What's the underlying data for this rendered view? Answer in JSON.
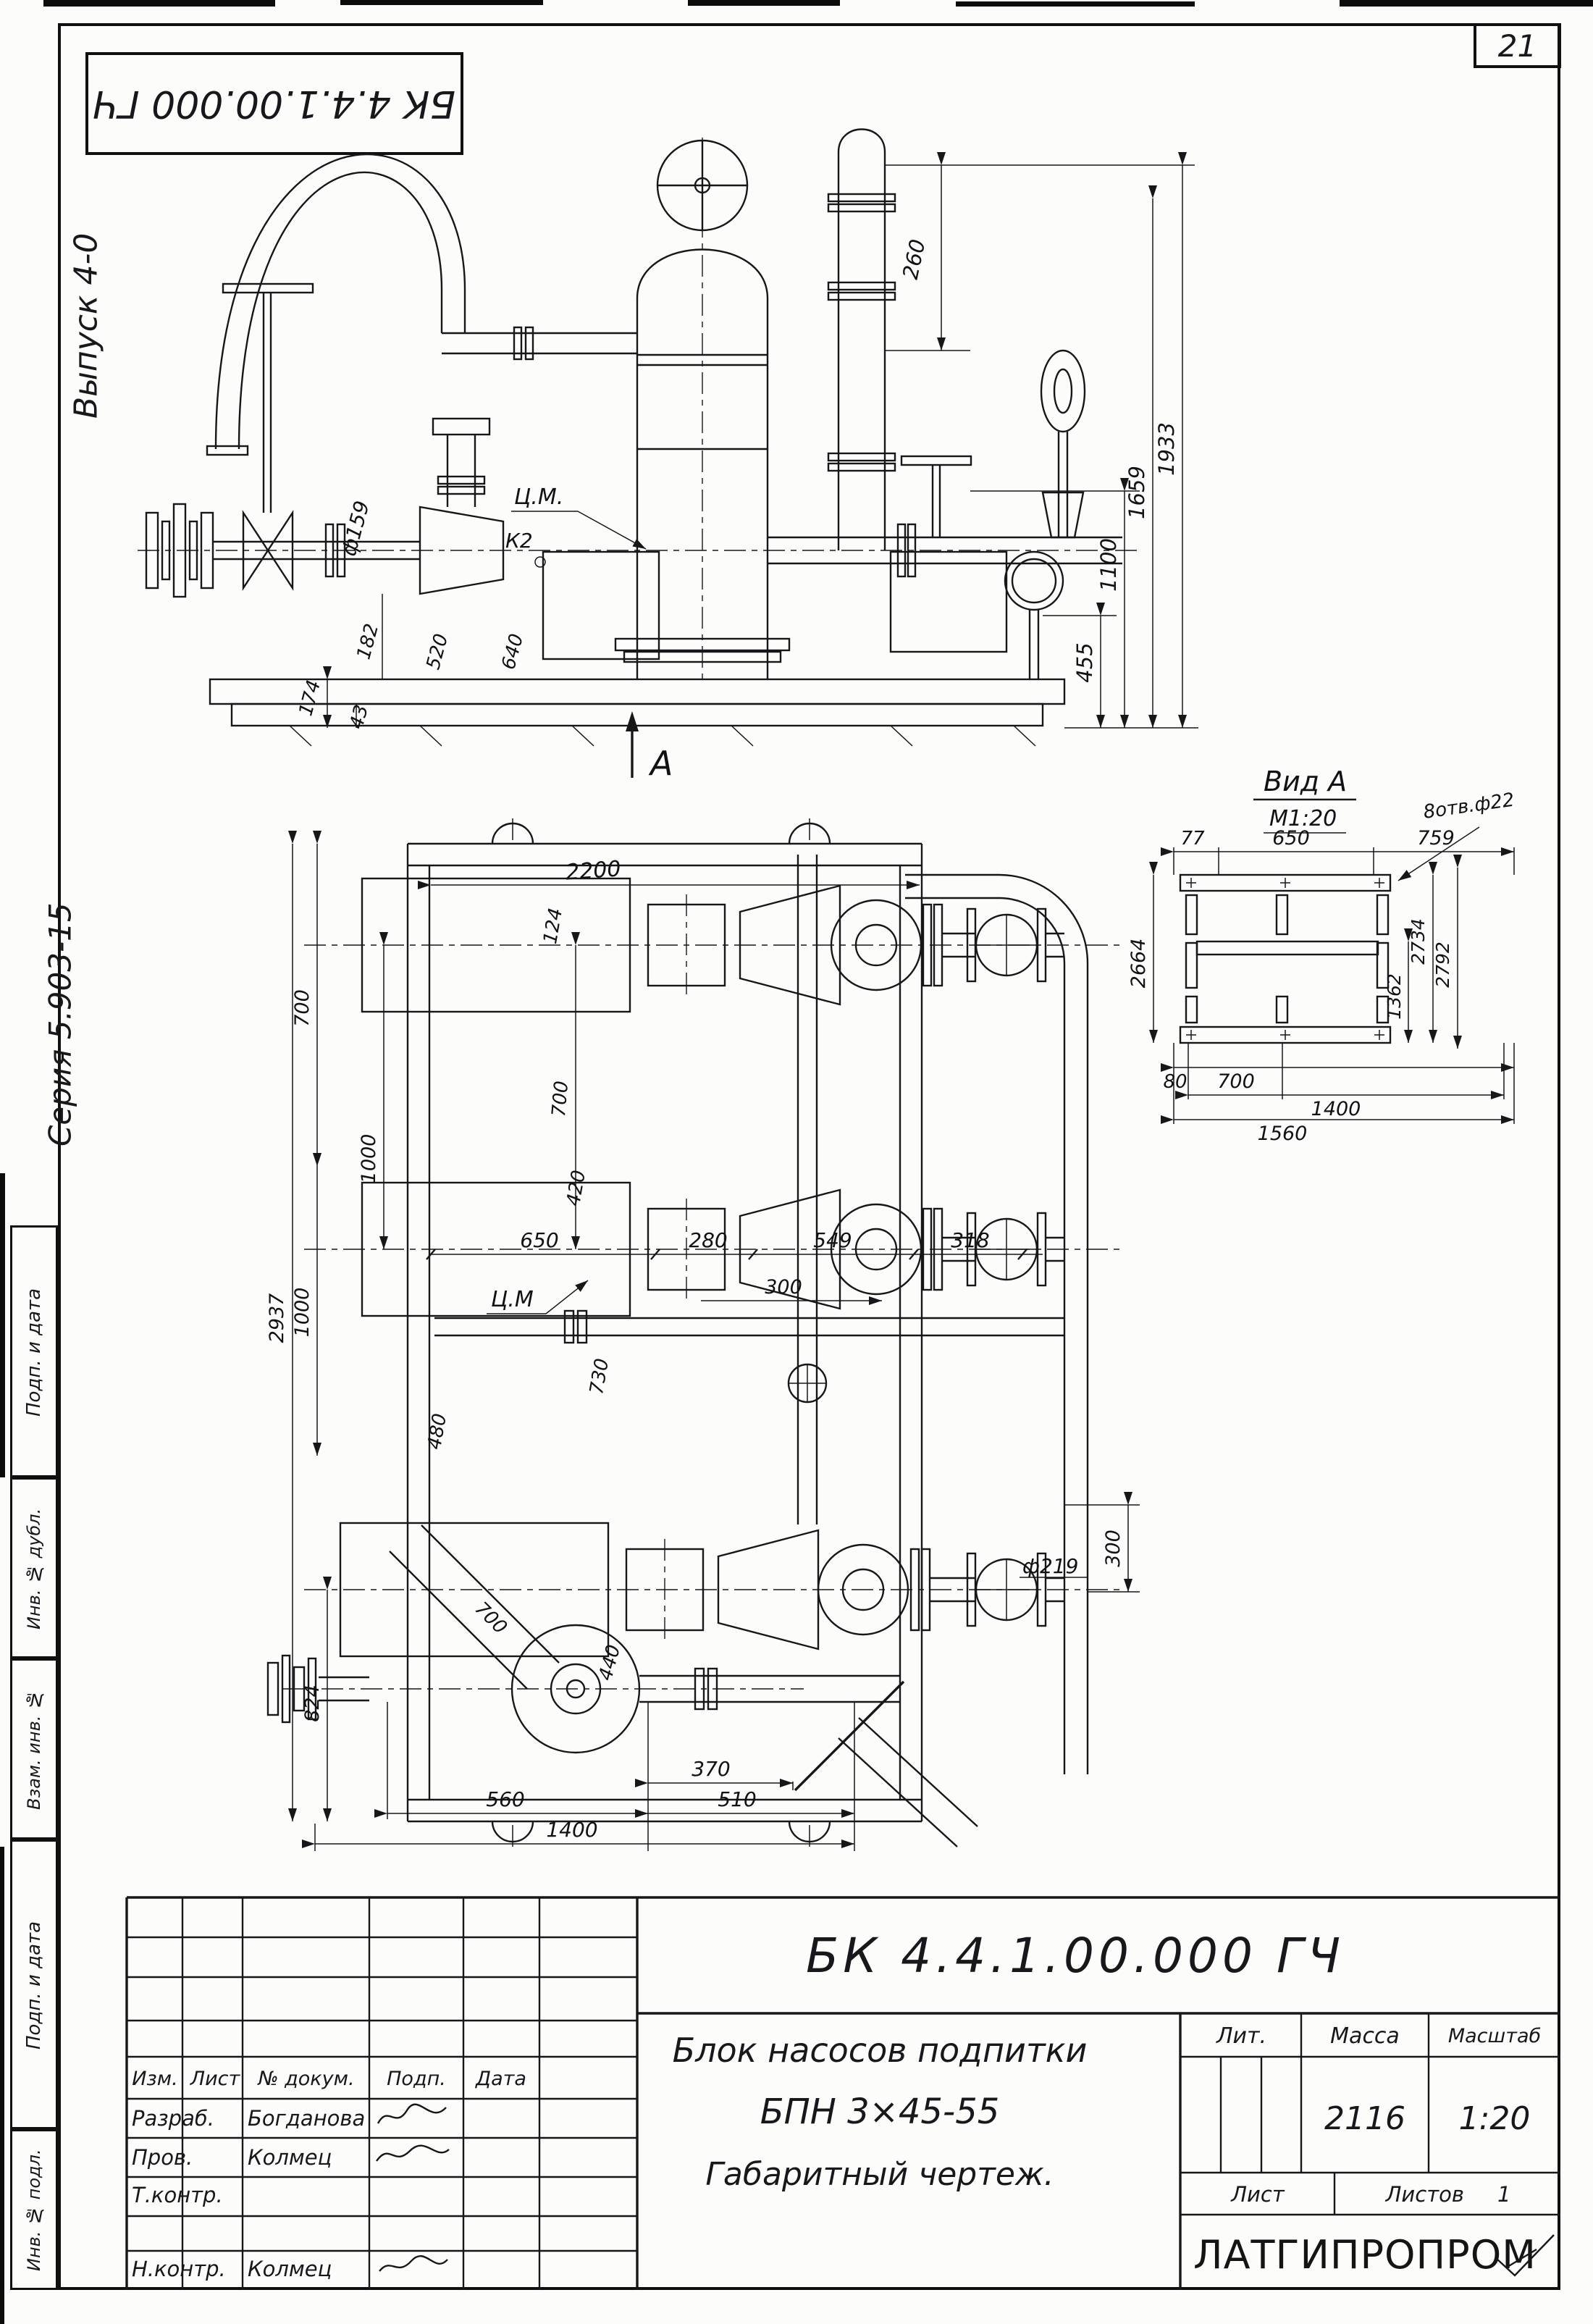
{
  "page": {
    "number": "21"
  },
  "corner_stamp": {
    "code": "БК 4.4.1.00.000 ГЧ"
  },
  "margin": {
    "issue": "Выпуск 4-0",
    "series": "Серия 5.903-15",
    "stamps": [
      {
        "label": "Подп. и дата"
      },
      {
        "label": "Инв. № дубл."
      },
      {
        "label": "Взам. инв. №"
      },
      {
        "label": "Подп. и дата"
      },
      {
        "label": "Инв. № подл."
      }
    ]
  },
  "front_view": {
    "section_label": "А",
    "center_of_mass": "Ц.М.",
    "callout_k2": "К2",
    "pipe_dia": "ф159",
    "dim_260": "260",
    "dim_455": "455",
    "dim_1100": "1100",
    "dim_1659": "1659",
    "dim_1933": "1933",
    "dim_174": "174",
    "dim_43": "43",
    "dim_182": "182",
    "dim_520": "520",
    "dim_640": "640"
  },
  "plan_view": {
    "center_of_mass": "Ц.М",
    "pipe_dia": "ф219",
    "dim_2200": "2200",
    "dim_124": "124",
    "dim_700_mid": "700",
    "dim_420": "420",
    "dim_700_left": "700",
    "dim_2937": "2937",
    "dim_1000_a": "1000",
    "dim_1000_b": "1000",
    "dim_824": "824",
    "dim_650": "650",
    "dim_280": "280",
    "dim_549": "549",
    "dim_318": "318",
    "dim_300_h": "300",
    "dim_300_v": "300",
    "dim_730": "730",
    "dim_480": "480",
    "dim_700_diag": "700",
    "dim_440": "440",
    "dim_370": "370",
    "dim_510": "510",
    "dim_560": "560",
    "dim_1400": "1400"
  },
  "view_a": {
    "title": "Вид А",
    "scale": "М1:20",
    "holes_note": "8отв.ф22",
    "dim_77": "77",
    "dim_650": "650",
    "dim_759": "759",
    "dim_2664": "2664",
    "dim_2734": "2734",
    "dim_2792": "2792",
    "dim_1362": "1362",
    "dim_80": "80",
    "dim_700": "700",
    "dim_1400": "1400",
    "dim_1560": "1560"
  },
  "title_block": {
    "doc_number": "БК 4.4.1.00.000 ГЧ",
    "product_line1": "Блок насосов подпитки",
    "product_line2": "БПН 3×45-55",
    "doc_type": "Габаритный чертеж.",
    "lit_label": "Лит.",
    "mass_label": "Масса",
    "scale_label": "Масштаб",
    "mass_value": "2116",
    "scale_value": "1:20",
    "sheet_label": "Лист",
    "sheets_label": "Листов",
    "sheets_value": "1",
    "organization": "ЛАТГИПРОПРОМ",
    "rev_columns": [
      "Изм.",
      "Лист",
      "№ докум.",
      "Подп.",
      "Дата"
    ],
    "signature_rows": [
      {
        "role": "Разраб.",
        "name": "Богданова"
      },
      {
        "role": "Пров.",
        "name": "Колмец"
      },
      {
        "role": "Т.контр.",
        "name": ""
      },
      {
        "role": "Н.контр.",
        "name": "Колмец"
      }
    ]
  }
}
